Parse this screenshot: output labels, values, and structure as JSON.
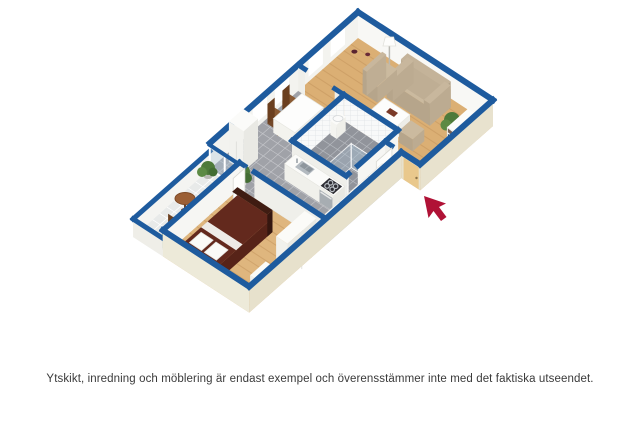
{
  "caption": {
    "text": "Ytskikt, inredning och möblering är endast exempel och överensstämmer inte med det faktiska utseendet."
  },
  "floorplan": {
    "type": "3d-isometric-floorplan",
    "style": "white walls with blue top caps, perspective cutaway view",
    "rooms": [
      {
        "name": "living-room",
        "floor": "wood"
      },
      {
        "name": "dining-area",
        "floor": "gray-tile"
      },
      {
        "name": "kitchen",
        "floor": "gray-tile"
      },
      {
        "name": "bathroom",
        "floor": "gray-tile",
        "walls": "white-tile"
      },
      {
        "name": "bedroom",
        "floor": "wood"
      },
      {
        "name": "balcony",
        "floor": "light-tile"
      },
      {
        "name": "hallway-entrance",
        "floor": "wood"
      }
    ],
    "furniture": [
      "sofa",
      "armchair",
      "coffee-table",
      "ottoman",
      "floor-lamp",
      "bookshelf",
      "potted-plant",
      "dining-table",
      "four-dining-chairs",
      "tall-cabinet",
      "kitchen-counter-with-sink",
      "stove-cooktop",
      "counter-row",
      "wall-sink",
      "shower-enclosure",
      "double-bed",
      "wardrobe",
      "dresser",
      "round-balcony-table",
      "two-balcony-chairs",
      "balcony-plants",
      "entrance-door",
      "open-door-panels",
      "balcony-glass-door"
    ],
    "entrance_arrow": {
      "icon": "entrance-arrow-icon",
      "direction": "up-left",
      "meaning": "entrance location"
    },
    "colors": {
      "wall_cap_blue": "#1E5B9E",
      "wood_floor": "#DBAF74",
      "bedroom_wood": "#DFB67E",
      "tile_floor": "#A0A2A8",
      "bathroom_tile": "#91949B",
      "balcony_tile": "#E8EAE9",
      "exterior_beige": "#E7E1CC",
      "bed_maroon": "#63291D",
      "sofa_beige": "#CBBA9F",
      "entrance_door_tan": "#E9C88C",
      "arrow_red": "#B01236",
      "chair_brown": "#8A5A33",
      "plant_green": "#4E7A3A",
      "glass_blue": "#AFC8DC"
    }
  }
}
